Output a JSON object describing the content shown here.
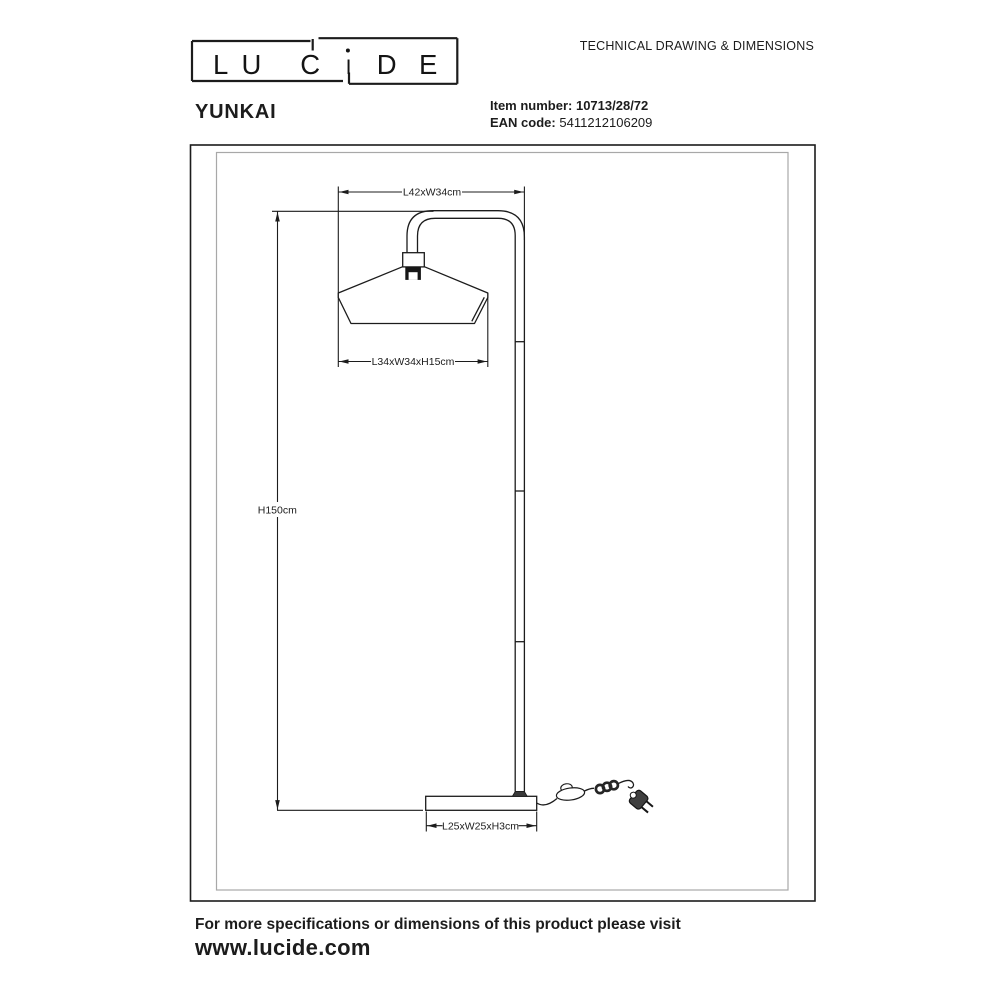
{
  "brand": {
    "letters": [
      "L",
      "U",
      "C",
      "I",
      "D",
      "E"
    ]
  },
  "header": {
    "doc_type": "TECHNICAL DRAWING & DIMENSIONS",
    "product_name": "YUNKAI",
    "item_number_label": "Item number:",
    "item_number_value": "10713/28/72",
    "ean_label": "EAN code:",
    "ean_value": "5411212106209"
  },
  "drawing": {
    "dimensions": {
      "arm_span": "L42xW34cm",
      "shade": "L34xW34xH15cm",
      "height": "H150cm",
      "base": "L25xW25xH3cm"
    }
  },
  "footer": {
    "note": "For more specifications or dimensions of this product please visit",
    "website": "www.lucide.com"
  }
}
